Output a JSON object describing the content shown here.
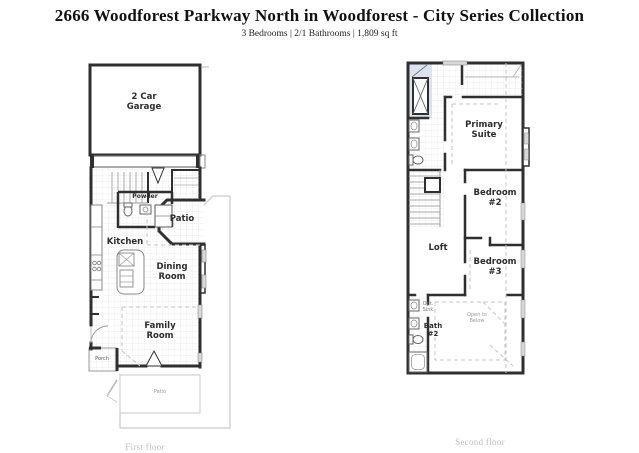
{
  "header": {
    "title": "2666 Woodforest Parkway North in Woodforest - City Series Collection",
    "subtitle": "3 Bedrooms | 2/1 Bathrooms | 1,809 sq ft"
  },
  "first_floor": {
    "caption": "First floor",
    "rooms": {
      "garage": "2 Car Garage",
      "powder": "Powder",
      "patio": "Patio",
      "kitchen": "Kitchen",
      "dining_room": "Dining Room",
      "family_room": "Family Room",
      "porch": "Porch",
      "rear_patio": "Patio"
    }
  },
  "second_floor": {
    "caption": "Second floor",
    "rooms": {
      "primary_suite": "Primary Suite",
      "bedroom_2": "Bedroom #2",
      "bedroom_3": "Bedroom #3",
      "loft": "Loft",
      "bath_2": "Bath #2",
      "opt_sink": "Opt. Sink",
      "open_to_below": "Open to Below"
    }
  },
  "colors": {
    "wall": "#2f2f2f",
    "tile_grid": "#e9e9e9",
    "dashed_line": "#c4c4c4",
    "lot_line": "#c9c9c9",
    "window_fill": "#d8d8d8",
    "shower_fill": "#dbe3ef",
    "caption_text": "#bdbdbd"
  }
}
